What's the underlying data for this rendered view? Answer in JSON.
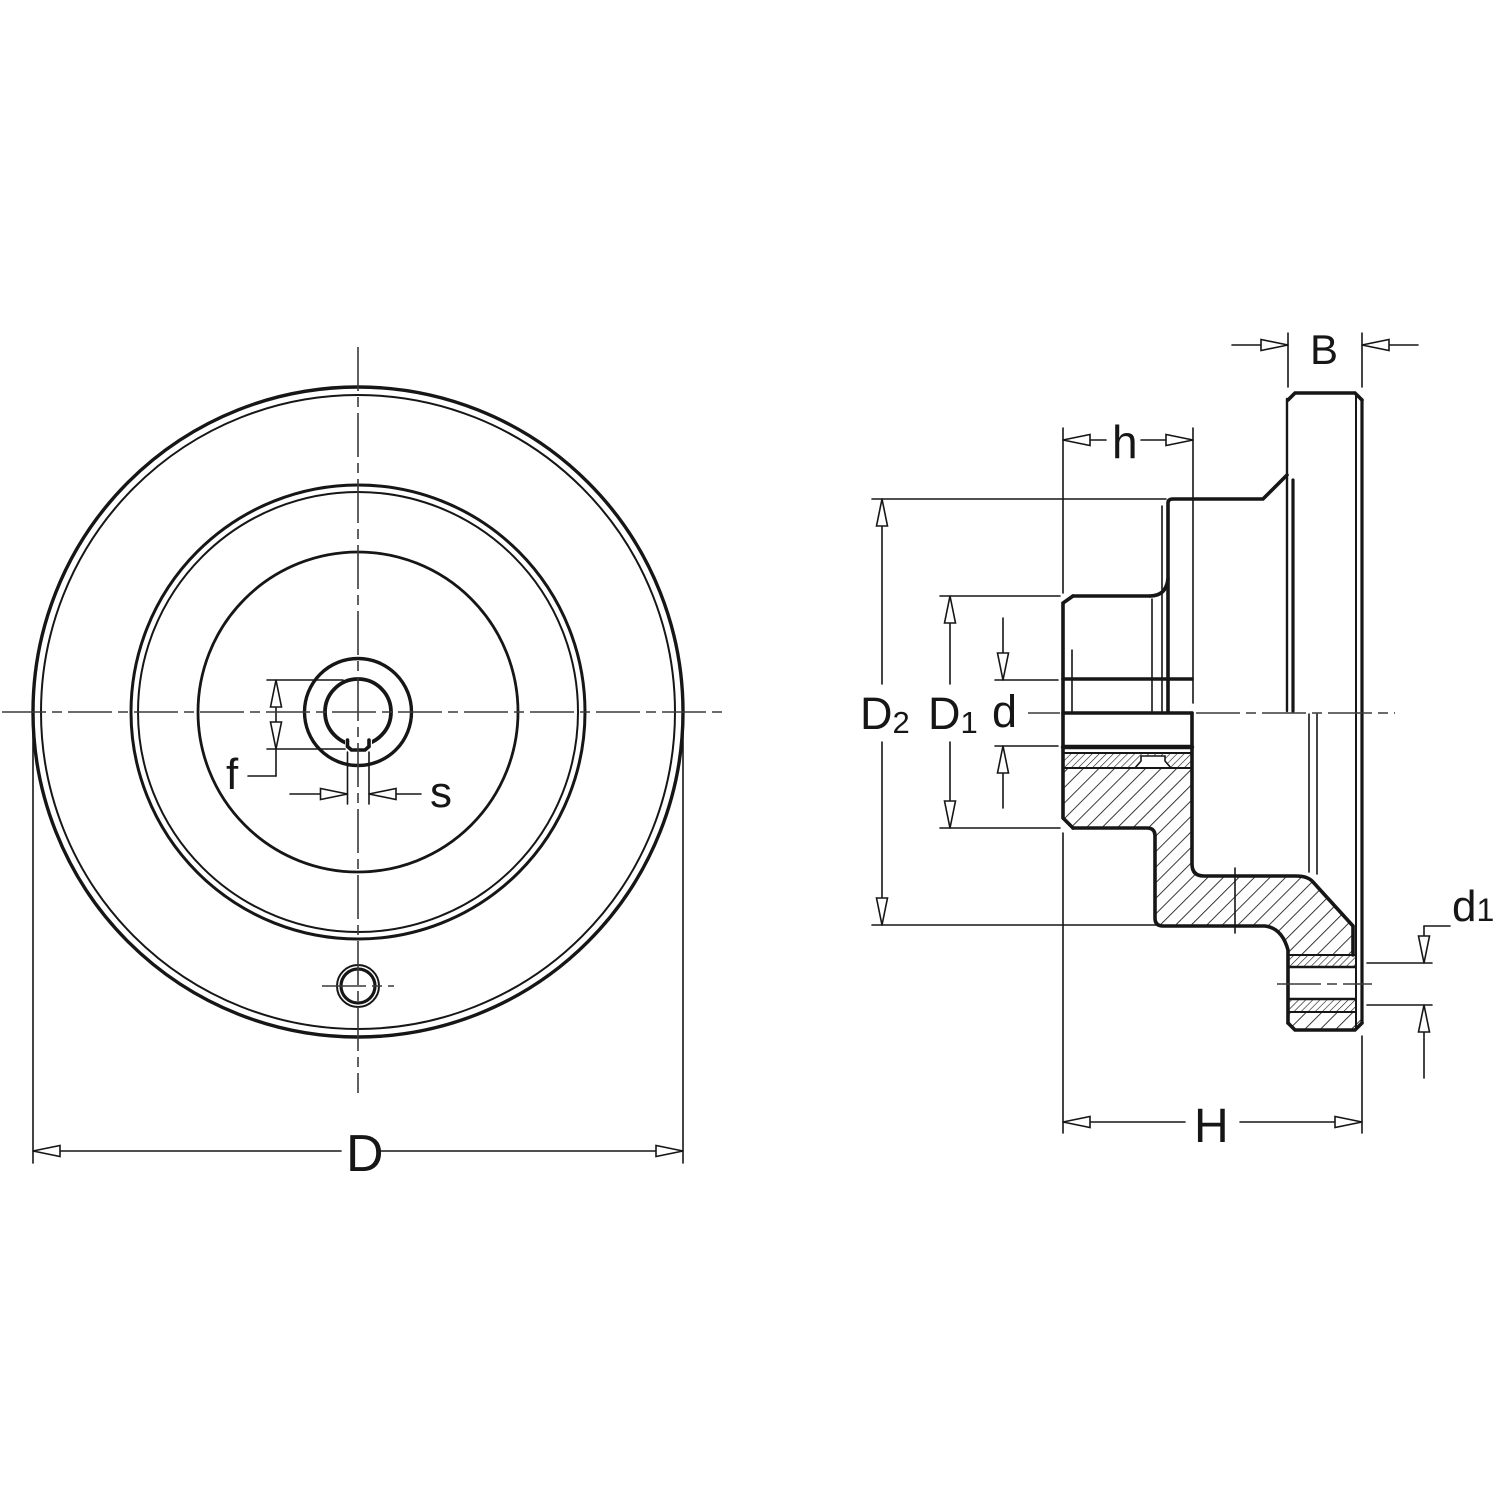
{
  "drawing": {
    "colors": {
      "line": "#161616",
      "background": "#ffffff"
    },
    "labels": {
      "D": "D",
      "f": "f",
      "s": "s",
      "B": "B",
      "h": "h",
      "H": "H",
      "d": "d",
      "D2_base": "D",
      "D2_sub": "2",
      "D1_base": "D",
      "D1_sub": "1",
      "d1_base": "d",
      "d1_sub": "1"
    }
  }
}
